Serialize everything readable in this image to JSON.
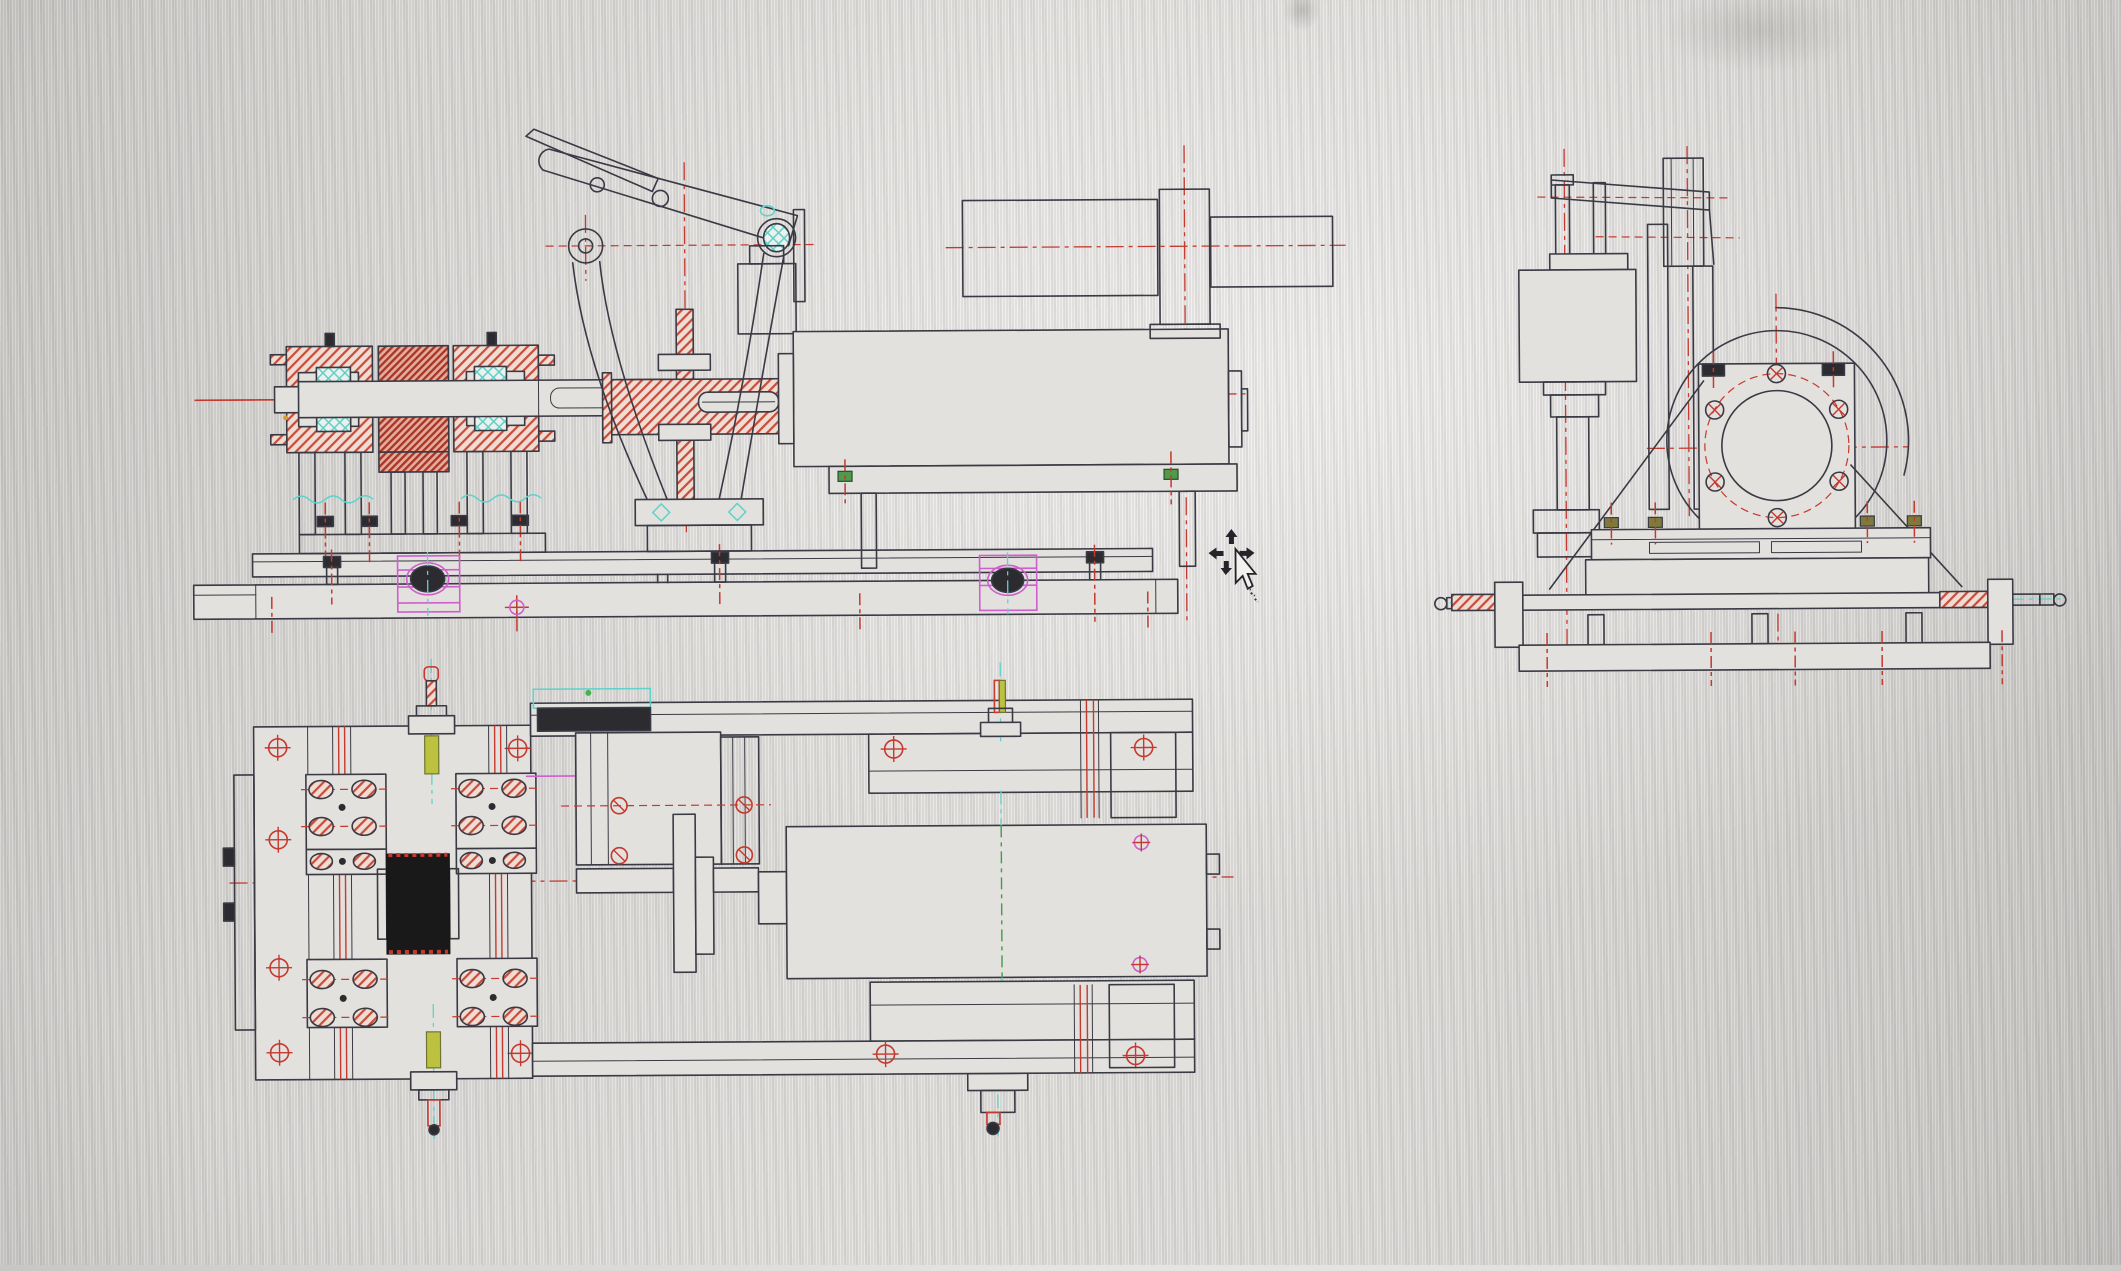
{
  "canvas": {
    "background_color": "#dddbd8",
    "content": "cad-engineering-drawing-three-views"
  },
  "views": {
    "front": "front-section-view",
    "side": "right-side-view",
    "plan": "top-plan-view"
  },
  "colors": {
    "line": "#3a3a44",
    "red": "#c5392e",
    "cyan": "#5fd2c9",
    "magenta": "#cf5ecf",
    "green": "#3f9e44",
    "yellow": "#bcc23f",
    "hatch": "#c84b3c",
    "dark_fill": "#191919"
  },
  "cursor": {
    "icon": "move-pan-cursor-with-pointer",
    "x": 1232,
    "y": 560
  }
}
